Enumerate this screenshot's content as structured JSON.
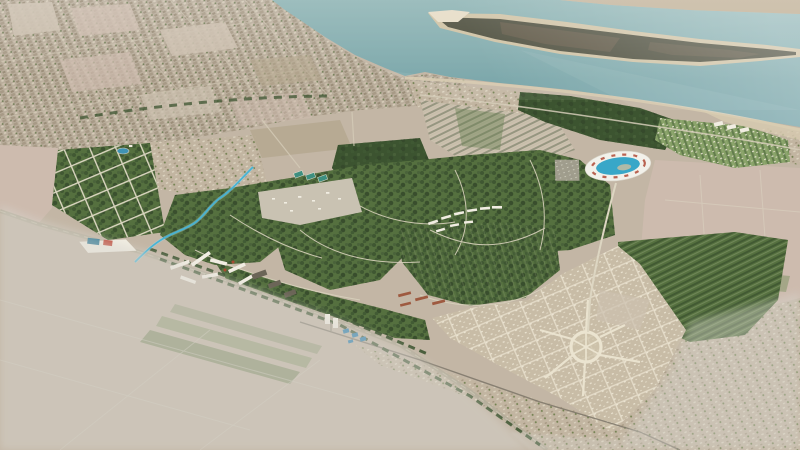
{
  "scene": {
    "kind": "aerial-masterplan-render",
    "description": "Oblique bird's-eye photorealistic rendering of a coastal city masterplan: teal river with a long vegetated sandbar island at top, existing beige city fabric on the upper left shore, a new green tree-filled planned district in the center with curving streets and white housing rows, an oval arena with blue water center, a new town with circular radial plaza at lower right, striped agricultural fields, and desaturated grey areas outside the project boundary at lower left and lower right",
    "visible_text": "none",
    "width_px": 800,
    "height_px": 450
  },
  "palette": {
    "fieldBase": "#c3b6a5",
    "fieldLight": "#ccc0af",
    "fieldPink": "#cdbbae",
    "fieldTan": "#b5a88f",
    "fieldGreen": "#7b9160",
    "cropGreen": "#5e7a49",
    "city": "#b9ad9b",
    "village": "#c2b5a1",
    "water": "#7ea8ab",
    "waterDeep": "#6f9ea4",
    "shoreSand": "#d8ccb2",
    "farShore": "#c7b9a2",
    "islandSand": "#cfc2a4",
    "islandDark": "#4e4f3e",
    "islandBrown": "#6a5f4c",
    "green": "#55703f",
    "greenDark": "#3c5430",
    "lawn": "#85a065",
    "clearing": "#c9c2b2",
    "road": "#b5ad9a",
    "roadLight": "#d5ccb8",
    "rail": "#7d7668",
    "street": "#ebe4d0",
    "newTown": "#c8bca6",
    "stream": "#45b4d6",
    "lake": "#3f93b4",
    "stadiumRing": "#f2f1ea",
    "stadiumBlue": "#38a7c8",
    "stadiumRed": "#b25340",
    "buildingWhite": "#f1ede2",
    "buildingDark": "#6b6557",
    "warehouseBlue": "#1f6f8e",
    "warehouseRed": "#bf4434",
    "redRoof": "#9e5a40",
    "courtTeal": "#3e8f80",
    "pavilionBlue": "#2b7fae",
    "fade": "#d8d6cf",
    "haze": "#ffffff"
  },
  "landmarks": [
    {
      "id": "river",
      "name": "wide teal river across the top"
    },
    {
      "id": "island",
      "name": "long dark sandbar island with white sand tip"
    },
    {
      "id": "far-shore",
      "name": "hazy far shoreline strip, top right corner"
    },
    {
      "id": "existing-city",
      "name": "existing low-rise city fabric, upper left"
    },
    {
      "id": "green-grid-district",
      "name": "tree-lined gridded residential district, mid left"
    },
    {
      "id": "central-green-district",
      "name": "large curving green planned neighborhoods, center"
    },
    {
      "id": "construction-site",
      "name": "light cleared construction area inside green district"
    },
    {
      "id": "white-terrace-rows",
      "name": "arc of white terraced housing rows"
    },
    {
      "id": "oval-arena",
      "name": "oval arena with white ring and blue water center"
    },
    {
      "id": "coastal-resort",
      "name": "orchard-row resort with white cottages near beach"
    },
    {
      "id": "new-town",
      "name": "new town with radial circular plaza, lower right"
    },
    {
      "id": "circular-plaza",
      "name": "large circular plaza with radiating avenues"
    },
    {
      "id": "main-highway",
      "name": "tree-lined highway crossing diagonally"
    },
    {
      "id": "railway",
      "name": "rail line parallel to the highway"
    },
    {
      "id": "stream",
      "name": "highlighted cyan meandering stream"
    },
    {
      "id": "small-lake",
      "name": "small blue lake in the grid district"
    },
    {
      "id": "warehouse",
      "name": "white logistics hall with blue and red roof stripes"
    },
    {
      "id": "apartment-bars",
      "name": "white apartment slab buildings along the highway"
    },
    {
      "id": "white-towers",
      "name": "pair of white towers by the highway"
    },
    {
      "id": "farmland",
      "name": "striped agricultural fields"
    },
    {
      "id": "faded-out-of-scope",
      "name": "grey desaturated land outside project boundary"
    }
  ]
}
